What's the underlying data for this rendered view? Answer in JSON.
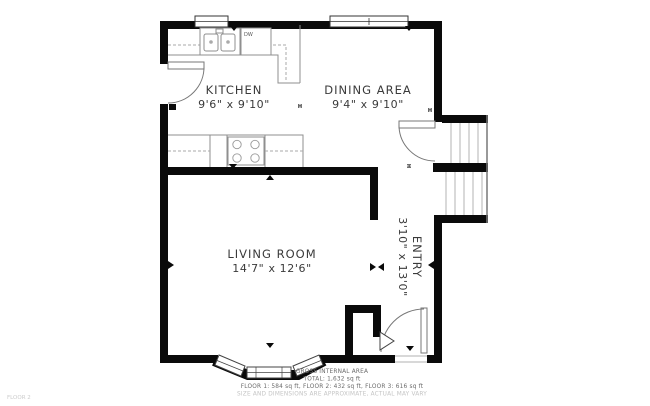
{
  "floor_label": "FLOOR 2",
  "rooms": {
    "kitchen": {
      "name": "KITCHEN",
      "dims": "9'6\" x 9'10\""
    },
    "dining": {
      "name": "DINING AREA",
      "dims": "9'4\" x 9'10\""
    },
    "living": {
      "name": "LIVING ROOM",
      "dims": "14'7\" x 12'6\""
    },
    "entry": {
      "name": "ENTRY",
      "dims": "3'10\" x 13'0\""
    }
  },
  "fixtures": {
    "dishwasher": "DW"
  },
  "footer": {
    "title": "GROSS INTERNAL AREA",
    "total": "TOTAL: 1,632 sq ft",
    "floors": "FLOOR 1: 584 sq ft, FLOOR 2: 432 sq ft, FLOOR 3: 616 sq ft",
    "disclaimer": "SIZE AND DIMENSIONS ARE APPROXIMATE, ACTUAL MAY VARY"
  },
  "colors": {
    "wall": "#0a0a0a",
    "line": "#8f8f8f",
    "text": "#3a3a3a",
    "muted": "#c4c4c4"
  }
}
